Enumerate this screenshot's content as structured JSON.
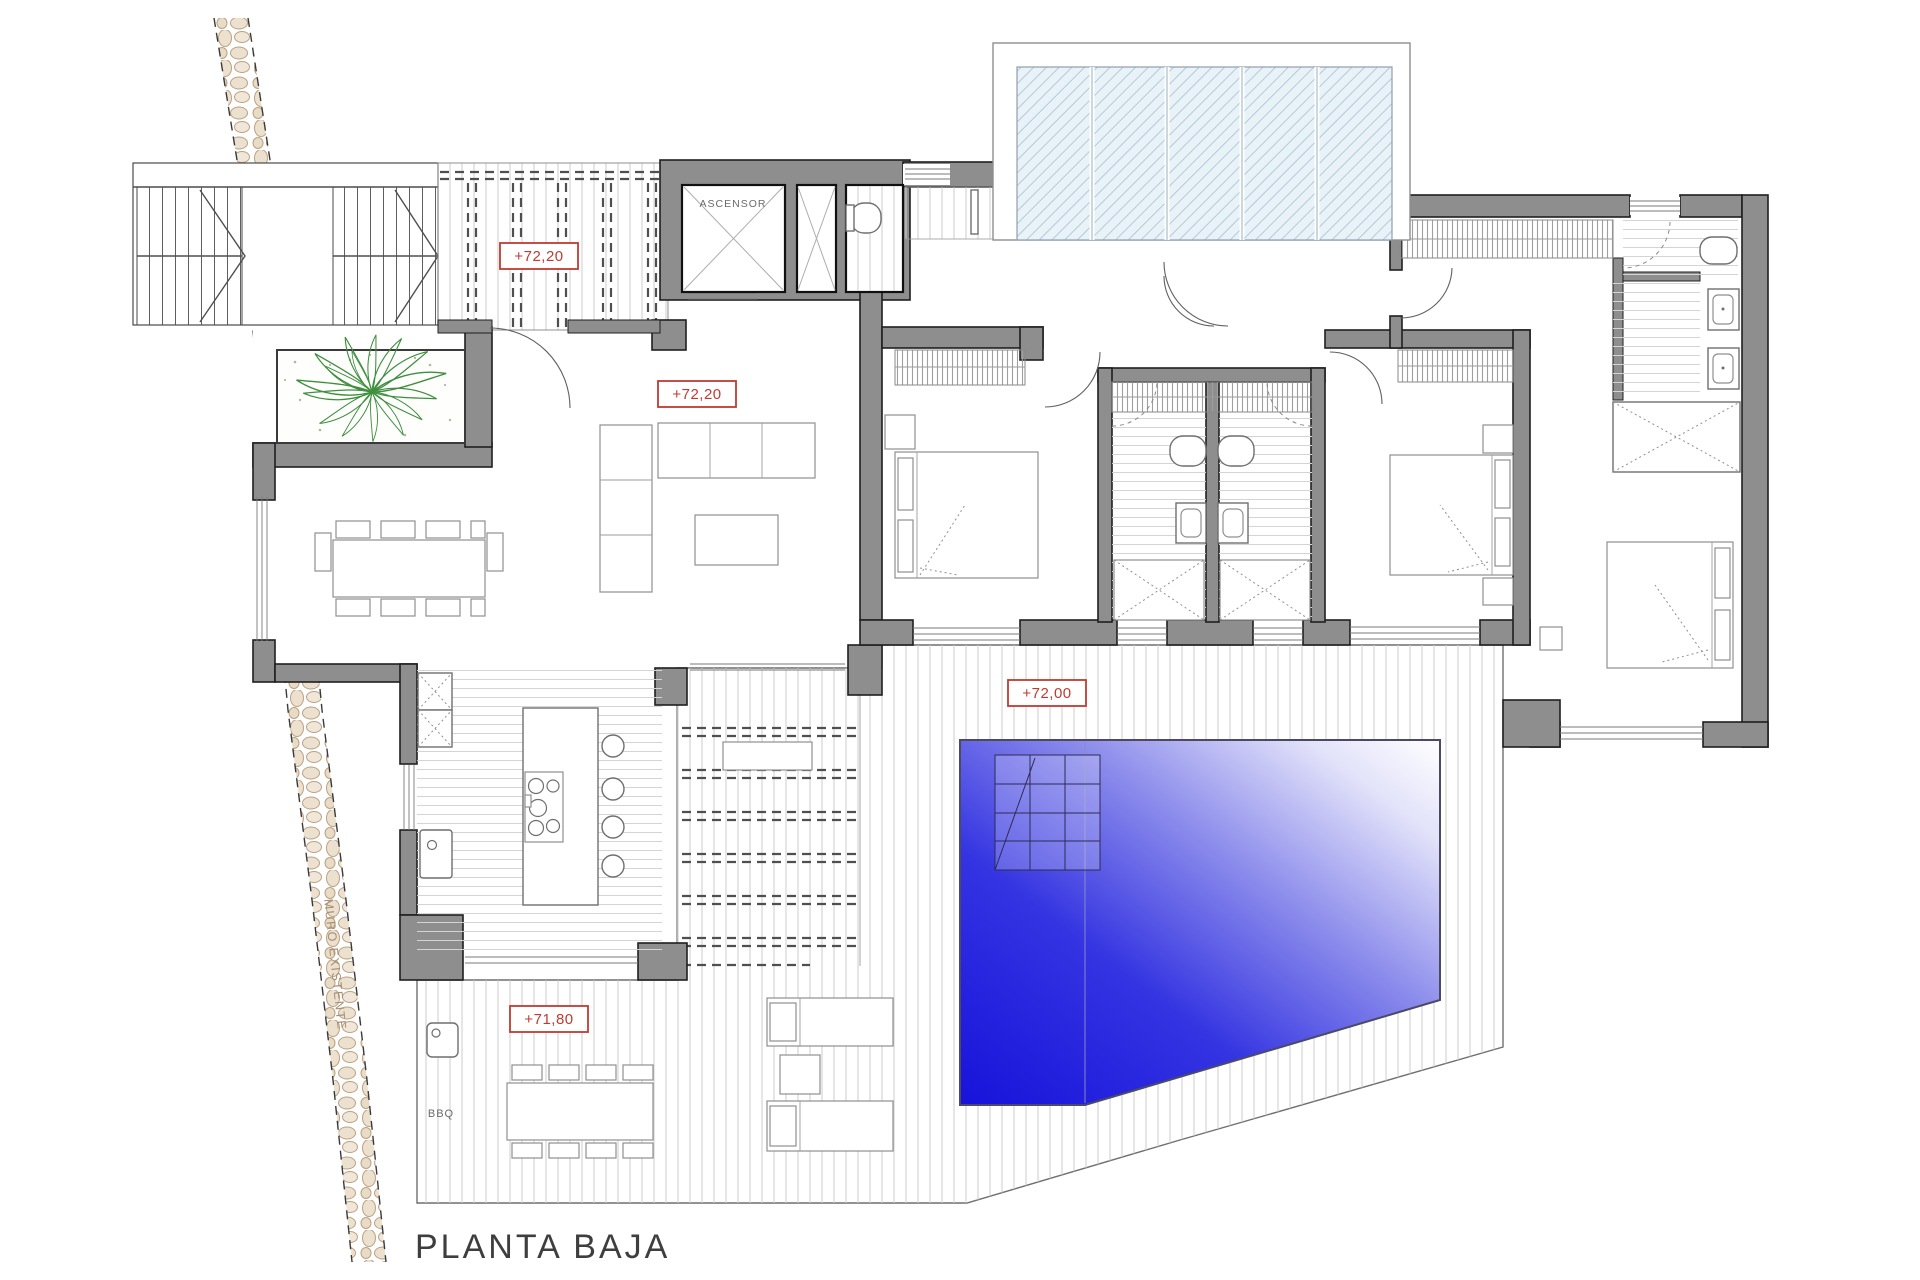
{
  "title": "PLANTA BAJA",
  "labels": {
    "elevator": "ASCENSOR",
    "level_pergola": "+72,20",
    "level_living": "+72,20",
    "level_terrace": "+72,00",
    "level_bbq": "+71,80",
    "bbq": "BBQ",
    "existing_wall": "MURO EXISTENTE"
  },
  "colors": {
    "wall_poche": "#8e8e8e",
    "level_marker_red": "#bf3b32",
    "pool_deep_blue": "#1a15dd",
    "pool_light": "#ffffff",
    "plant_green": "#3f8f3f",
    "stone_path": "#ece1cf",
    "skylight_glass": "#e9f2f7",
    "title_text": "#3e3e3e"
  }
}
